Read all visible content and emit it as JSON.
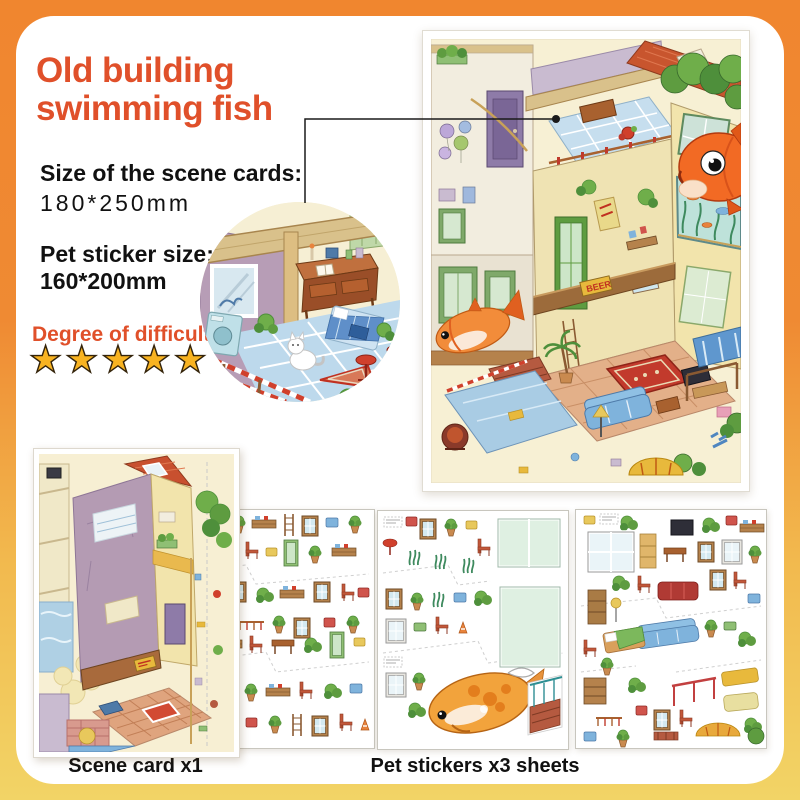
{
  "theme": {
    "accent": "#E0502A",
    "bg-top": "#F0862F",
    "bg-bottom": "#F2D466",
    "star": "#F8B321",
    "text": "#111111"
  },
  "title": {
    "line1": "Old building",
    "line2": "swimming fish"
  },
  "specs": {
    "scene_size_label": "Size of the scene cards:",
    "scene_size_value": "180*250mm",
    "pet_size_label": "Pet sticker size:",
    "pet_size_value": "160*200mm"
  },
  "difficulty": {
    "label": "Degree of difficulty",
    "stars": 5,
    "stars_text": "★★★★★"
  },
  "captions": {
    "scene_card": "Scene card x1",
    "pet_stickers": "Pet stickers x3 sheets"
  },
  "artwork": {
    "beer_sign": "BEER"
  }
}
